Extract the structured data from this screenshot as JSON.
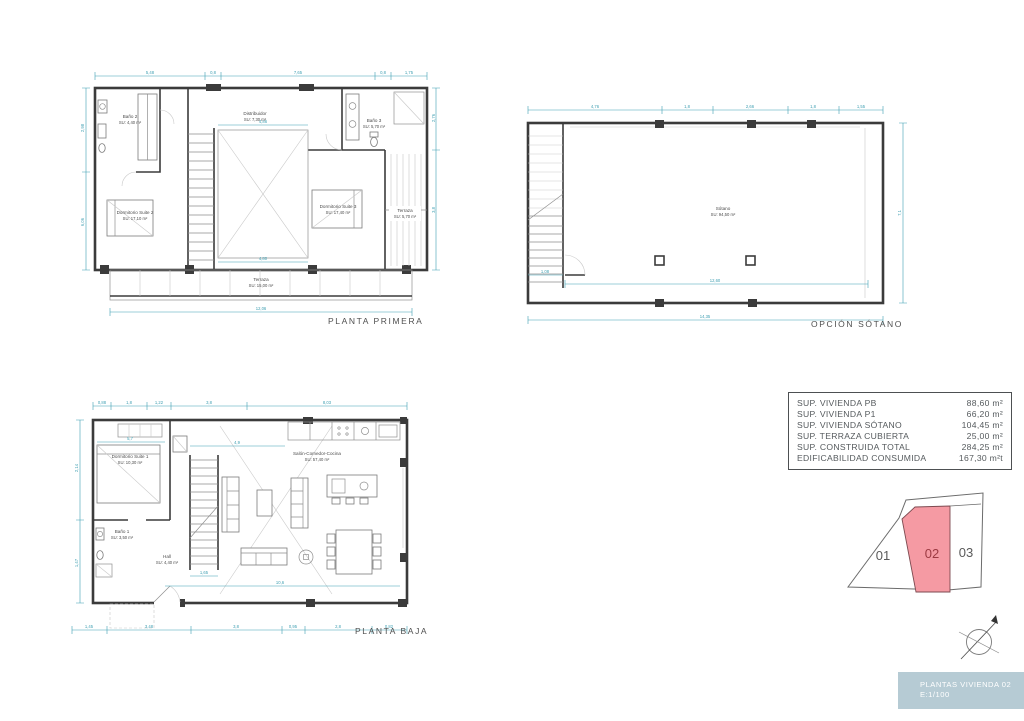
{
  "colors": {
    "dimension": "#3f9fb2",
    "wall": "#3b3b3b",
    "lot_highlight": "#f59aa3",
    "lot_highlight_text": "#9c3a42",
    "titlebox_bg": "#b6cbd4"
  },
  "plans": {
    "planta_primera": {
      "title": "PLANTA PRIMERA",
      "rooms": {
        "bano2": {
          "name": "Baño 2",
          "area": "SU: 4,40 m²"
        },
        "dormitorio2": {
          "name": "Dormitorio Suite 2",
          "area": "SU: 17,10 m²"
        },
        "distribuidor": {
          "name": "Distribuidor",
          "area": "SU: 7,30 m²"
        },
        "bano3": {
          "name": "Baño 3",
          "area": "SU: 5,70 m²"
        },
        "dormitorio3": {
          "name": "Dormitorio Suite 3",
          "area": "SU: 17,40 m²"
        },
        "terraza_lateral": {
          "name": "Terraza",
          "area": "SU: 5,70 m²"
        },
        "terraza": {
          "name": "Terraza",
          "area": "SU: 15,00 m²"
        }
      },
      "dims": {
        "top": [
          "5,48",
          "0,8",
          "7,65",
          "0,8",
          "1,75"
        ],
        "bottom": "12,06",
        "inner_top": "4,86",
        "inner_bottom": "4,80",
        "left": [
          "2,98",
          "6,06"
        ],
        "right": [
          "2,76",
          "3,8"
        ]
      }
    },
    "opcion_sotano": {
      "title": "OPCIÓN SÓTANO",
      "rooms": {
        "sotano": {
          "name": "Sótano",
          "area": "SU: 94,50 m²"
        }
      },
      "dims": {
        "top": [
          "4,76",
          "1,8",
          "2,66",
          "1,8",
          "1,55"
        ],
        "bottom": "14,35",
        "inner": "12,60",
        "stair": "1,08",
        "right": "7,1"
      }
    },
    "planta_baja": {
      "title": "PLANTA BAJA",
      "rooms": {
        "dormitorio1": {
          "name": "Dormitorio Suite 1",
          "area": "SU: 10,30 m²"
        },
        "bano1": {
          "name": "Baño 1",
          "area": "SU: 3,50 m²"
        },
        "hall": {
          "name": "Hall",
          "area": "SU: 4,40 m²"
        },
        "salon": {
          "name": "Salón-Comedor-Cocina",
          "area": "SU: 57,40 m²"
        }
      },
      "dims": {
        "top": [
          "0,88",
          "1,8",
          "1,22",
          "3,8",
          "8,03"
        ],
        "bottom": [
          "1,45",
          "3,48",
          "3,8",
          "0,95",
          "2,8",
          "0,82"
        ],
        "left": [
          "2,14",
          "1,47"
        ],
        "inner": [
          "5,7",
          "4,9",
          "10,6",
          "1,65"
        ]
      }
    }
  },
  "summary": {
    "rows": [
      {
        "label": "SUP. VIVIENDA PB",
        "value": "88,60 m²"
      },
      {
        "label": "SUP. VIVIENDA P1",
        "value": "66,20 m²"
      },
      {
        "label": "SUP. VIVIENDA SÓTANO",
        "value": "104,45 m²"
      },
      {
        "label": "SUP. TERRAZA CUBIERTA",
        "value": "25,00 m²"
      },
      {
        "label": "SUP. CONSTRUIDA TOTAL",
        "value": "284,25 m²"
      },
      {
        "label": "EDIFICABILIDAD CONSUMIDA",
        "value": "167,30 m²t"
      }
    ]
  },
  "plot_selector": {
    "lots": [
      {
        "id": "01",
        "highlighted": false
      },
      {
        "id": "02",
        "highlighted": true
      },
      {
        "id": "03",
        "highlighted": false
      }
    ]
  },
  "title_box": {
    "line1": "PLANTAS VIVIENDA 02",
    "line2": "E:1/100"
  }
}
